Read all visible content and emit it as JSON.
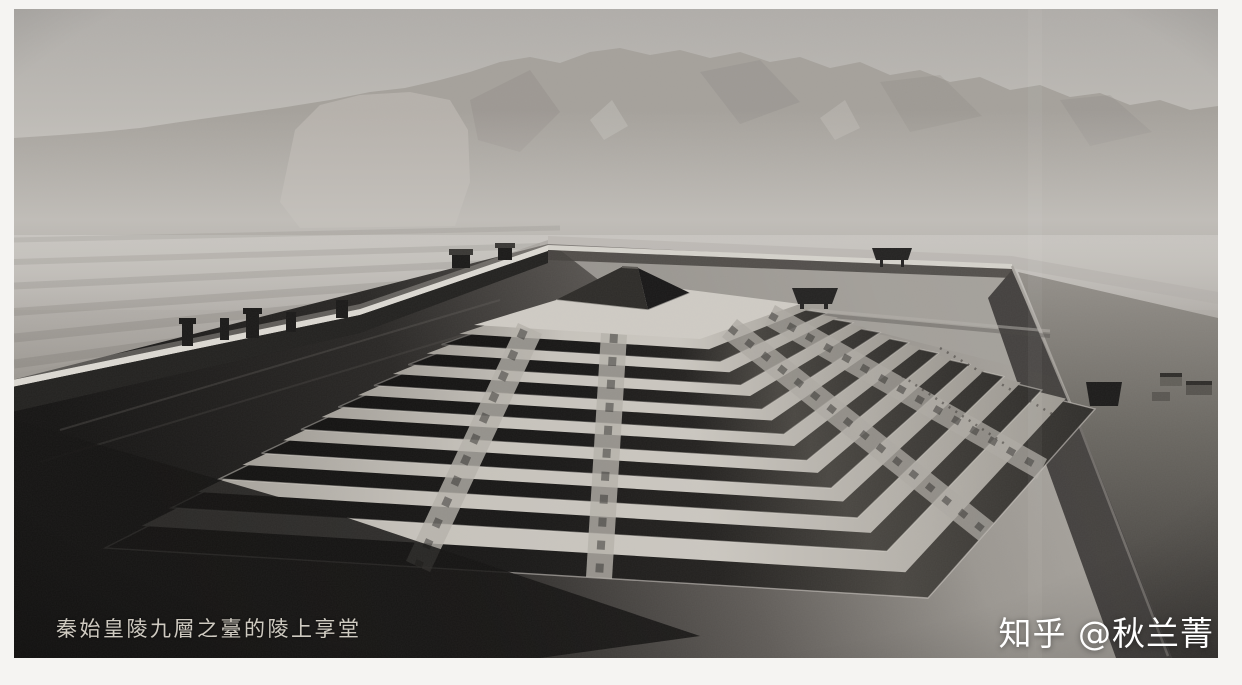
{
  "photo": {
    "alt": "Black-and-white aerial view of a reconstruction model: the nine-tiered terraced mound with a memorial hall on top of Qin Shi Huang's mausoleum, enclosed by walls with gate towers, hazy Mount Li range behind",
    "caption": "秦始皇陵九層之臺的陵上享堂",
    "watermark": "知乎 @秋兰菁"
  },
  "palette": {
    "page-margin": "#f5f4f2",
    "sky-top": "#b0ada9",
    "haze": "#c9c6c1",
    "mountain": "#a5a19b",
    "mountain-shadow": "#8a8680",
    "plain": "#938f89",
    "fields": "#807c76",
    "terrace-light": "#cdc9c2",
    "roof-dark": "#161514",
    "wall-highlight": "#dcd9d2",
    "wall-shadow": "#232220",
    "ground-dark": "#1b1a19",
    "caption-color": "#ded9cf",
    "watermark-color": "#ffffff"
  },
  "scene": {
    "tier_count": 9,
    "roof_fraction": 0.55,
    "ease": 0.78,
    "outer": {
      "n": [
        617,
        287
      ],
      "w": [
        105,
        548
      ],
      "s": [
        928,
        598
      ],
      "e": [
        1095,
        409
      ]
    },
    "inner": {
      "n": [
        619,
        281
      ],
      "w": [
        474,
        325
      ],
      "s": [
        700,
        339
      ],
      "e": [
        800,
        304
      ]
    }
  }
}
